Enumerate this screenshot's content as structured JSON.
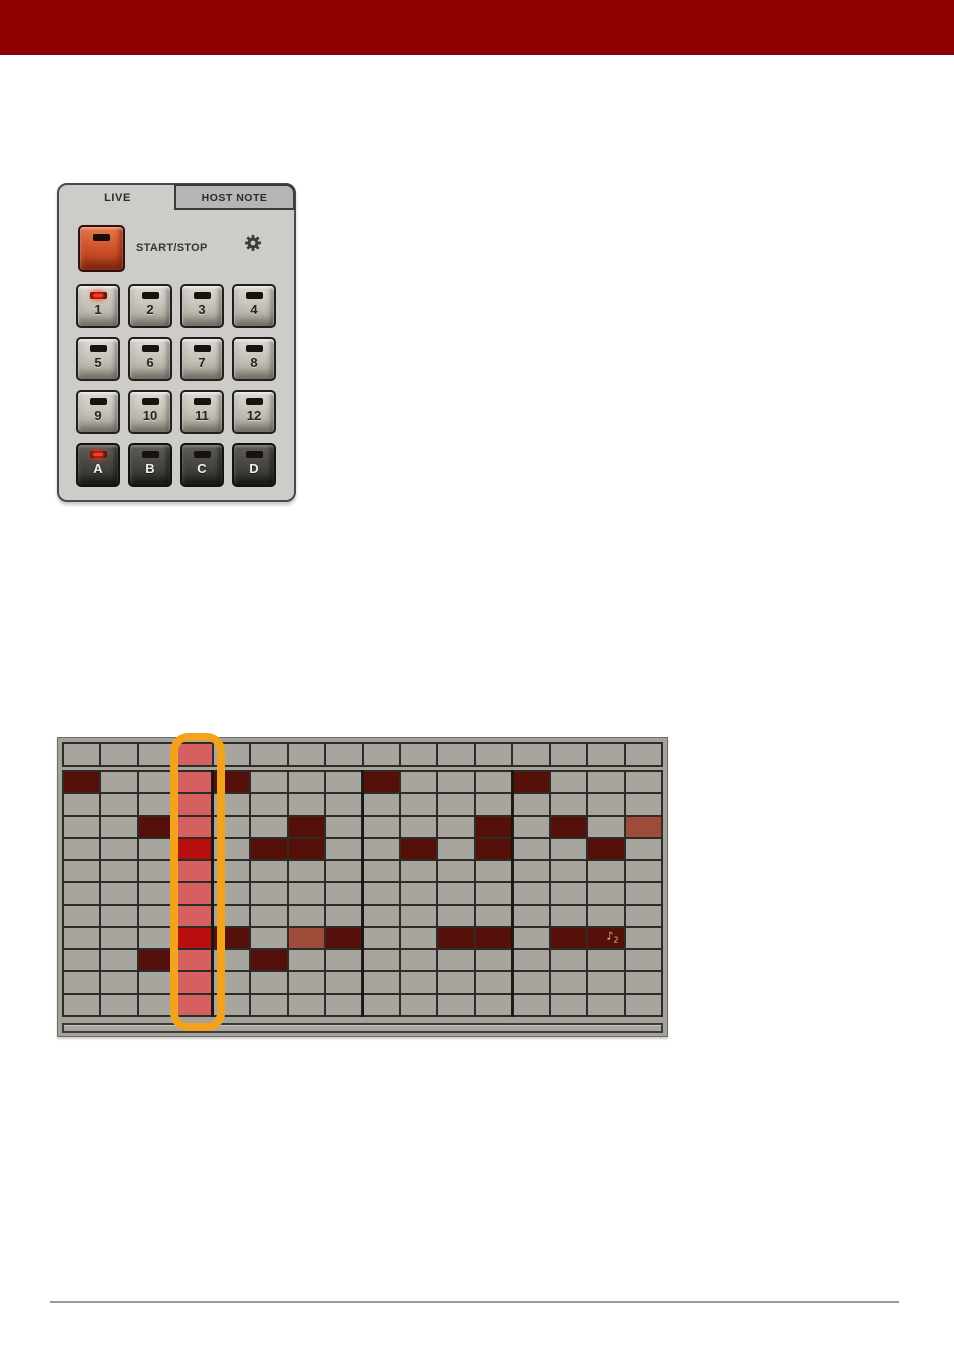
{
  "header": {
    "bar_color": "#8f0000"
  },
  "device_panel": {
    "tabs": [
      {
        "label": "LIVE",
        "active": true
      },
      {
        "label": "HOST NOTE",
        "active": false
      }
    ],
    "transport": {
      "start_stop_label": "START/STOP"
    },
    "pads": [
      {
        "label": "1",
        "dark": false,
        "led": true
      },
      {
        "label": "2",
        "dark": false,
        "led": false
      },
      {
        "label": "3",
        "dark": false,
        "led": false
      },
      {
        "label": "4",
        "dark": false,
        "led": false
      },
      {
        "label": "5",
        "dark": false,
        "led": false
      },
      {
        "label": "6",
        "dark": false,
        "led": false
      },
      {
        "label": "7",
        "dark": false,
        "led": false
      },
      {
        "label": "8",
        "dark": false,
        "led": false
      },
      {
        "label": "9",
        "dark": false,
        "led": false
      },
      {
        "label": "10",
        "dark": false,
        "led": false
      },
      {
        "label": "11",
        "dark": false,
        "led": false
      },
      {
        "label": "12",
        "dark": false,
        "led": false
      },
      {
        "label": "A",
        "dark": true,
        "led": true
      },
      {
        "label": "B",
        "dark": true,
        "led": false
      },
      {
        "label": "C",
        "dark": true,
        "led": false
      },
      {
        "label": "D",
        "dark": true,
        "led": false
      }
    ]
  },
  "sequencer": {
    "columns": 16,
    "header_row": "...s............",
    "rows": [
      "N..sN...N...N...",
      "...s............",
      "..Ns..N....N.N.m",
      "...A.NN..N.N..N.",
      "...s............",
      "...s............",
      "...s............",
      "...AN.mN..NN.NN.",
      "..Ns.N..........",
      "...s............",
      "...s............"
    ],
    "legend": {
      "N": "note",
      "m": "muted-note",
      "s": "playhead-empty",
      "A": "playhead-note",
      ".": "empty"
    },
    "note_icon": {
      "row": 8,
      "col": 15,
      "glyph": "♪",
      "subscript": "2"
    },
    "colors": {
      "cell": "#a8a49e",
      "note": "#551009",
      "muted": "#9e4c3a",
      "playhead": "#d66060",
      "playhead_note": "#b90e0e",
      "gridline": "#2e2c29",
      "outline": "#f2a21c"
    }
  }
}
